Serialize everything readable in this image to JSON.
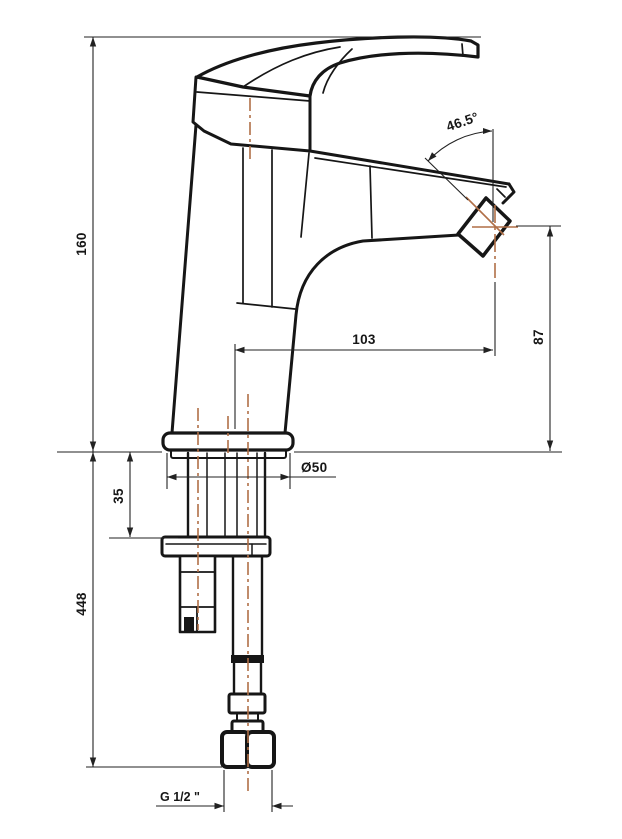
{
  "drawing": {
    "type": "technical-drawing",
    "subject": "single-lever basin mixer faucet, side elevation with installation dimensions (mm)",
    "labels": {
      "height_above_deck": "160",
      "hose_length_below_deck": "448",
      "deck_thickness": "35",
      "spout_reach": "103",
      "outlet_height": "87",
      "base_diameter": "Ø50",
      "outlet_angle": "46.5°",
      "connection_thread": "G 1/2 \""
    },
    "colors": {
      "line": "#161616",
      "dimension_line": "#222222",
      "centerline": "#b06f47",
      "background": "#ffffff"
    }
  }
}
